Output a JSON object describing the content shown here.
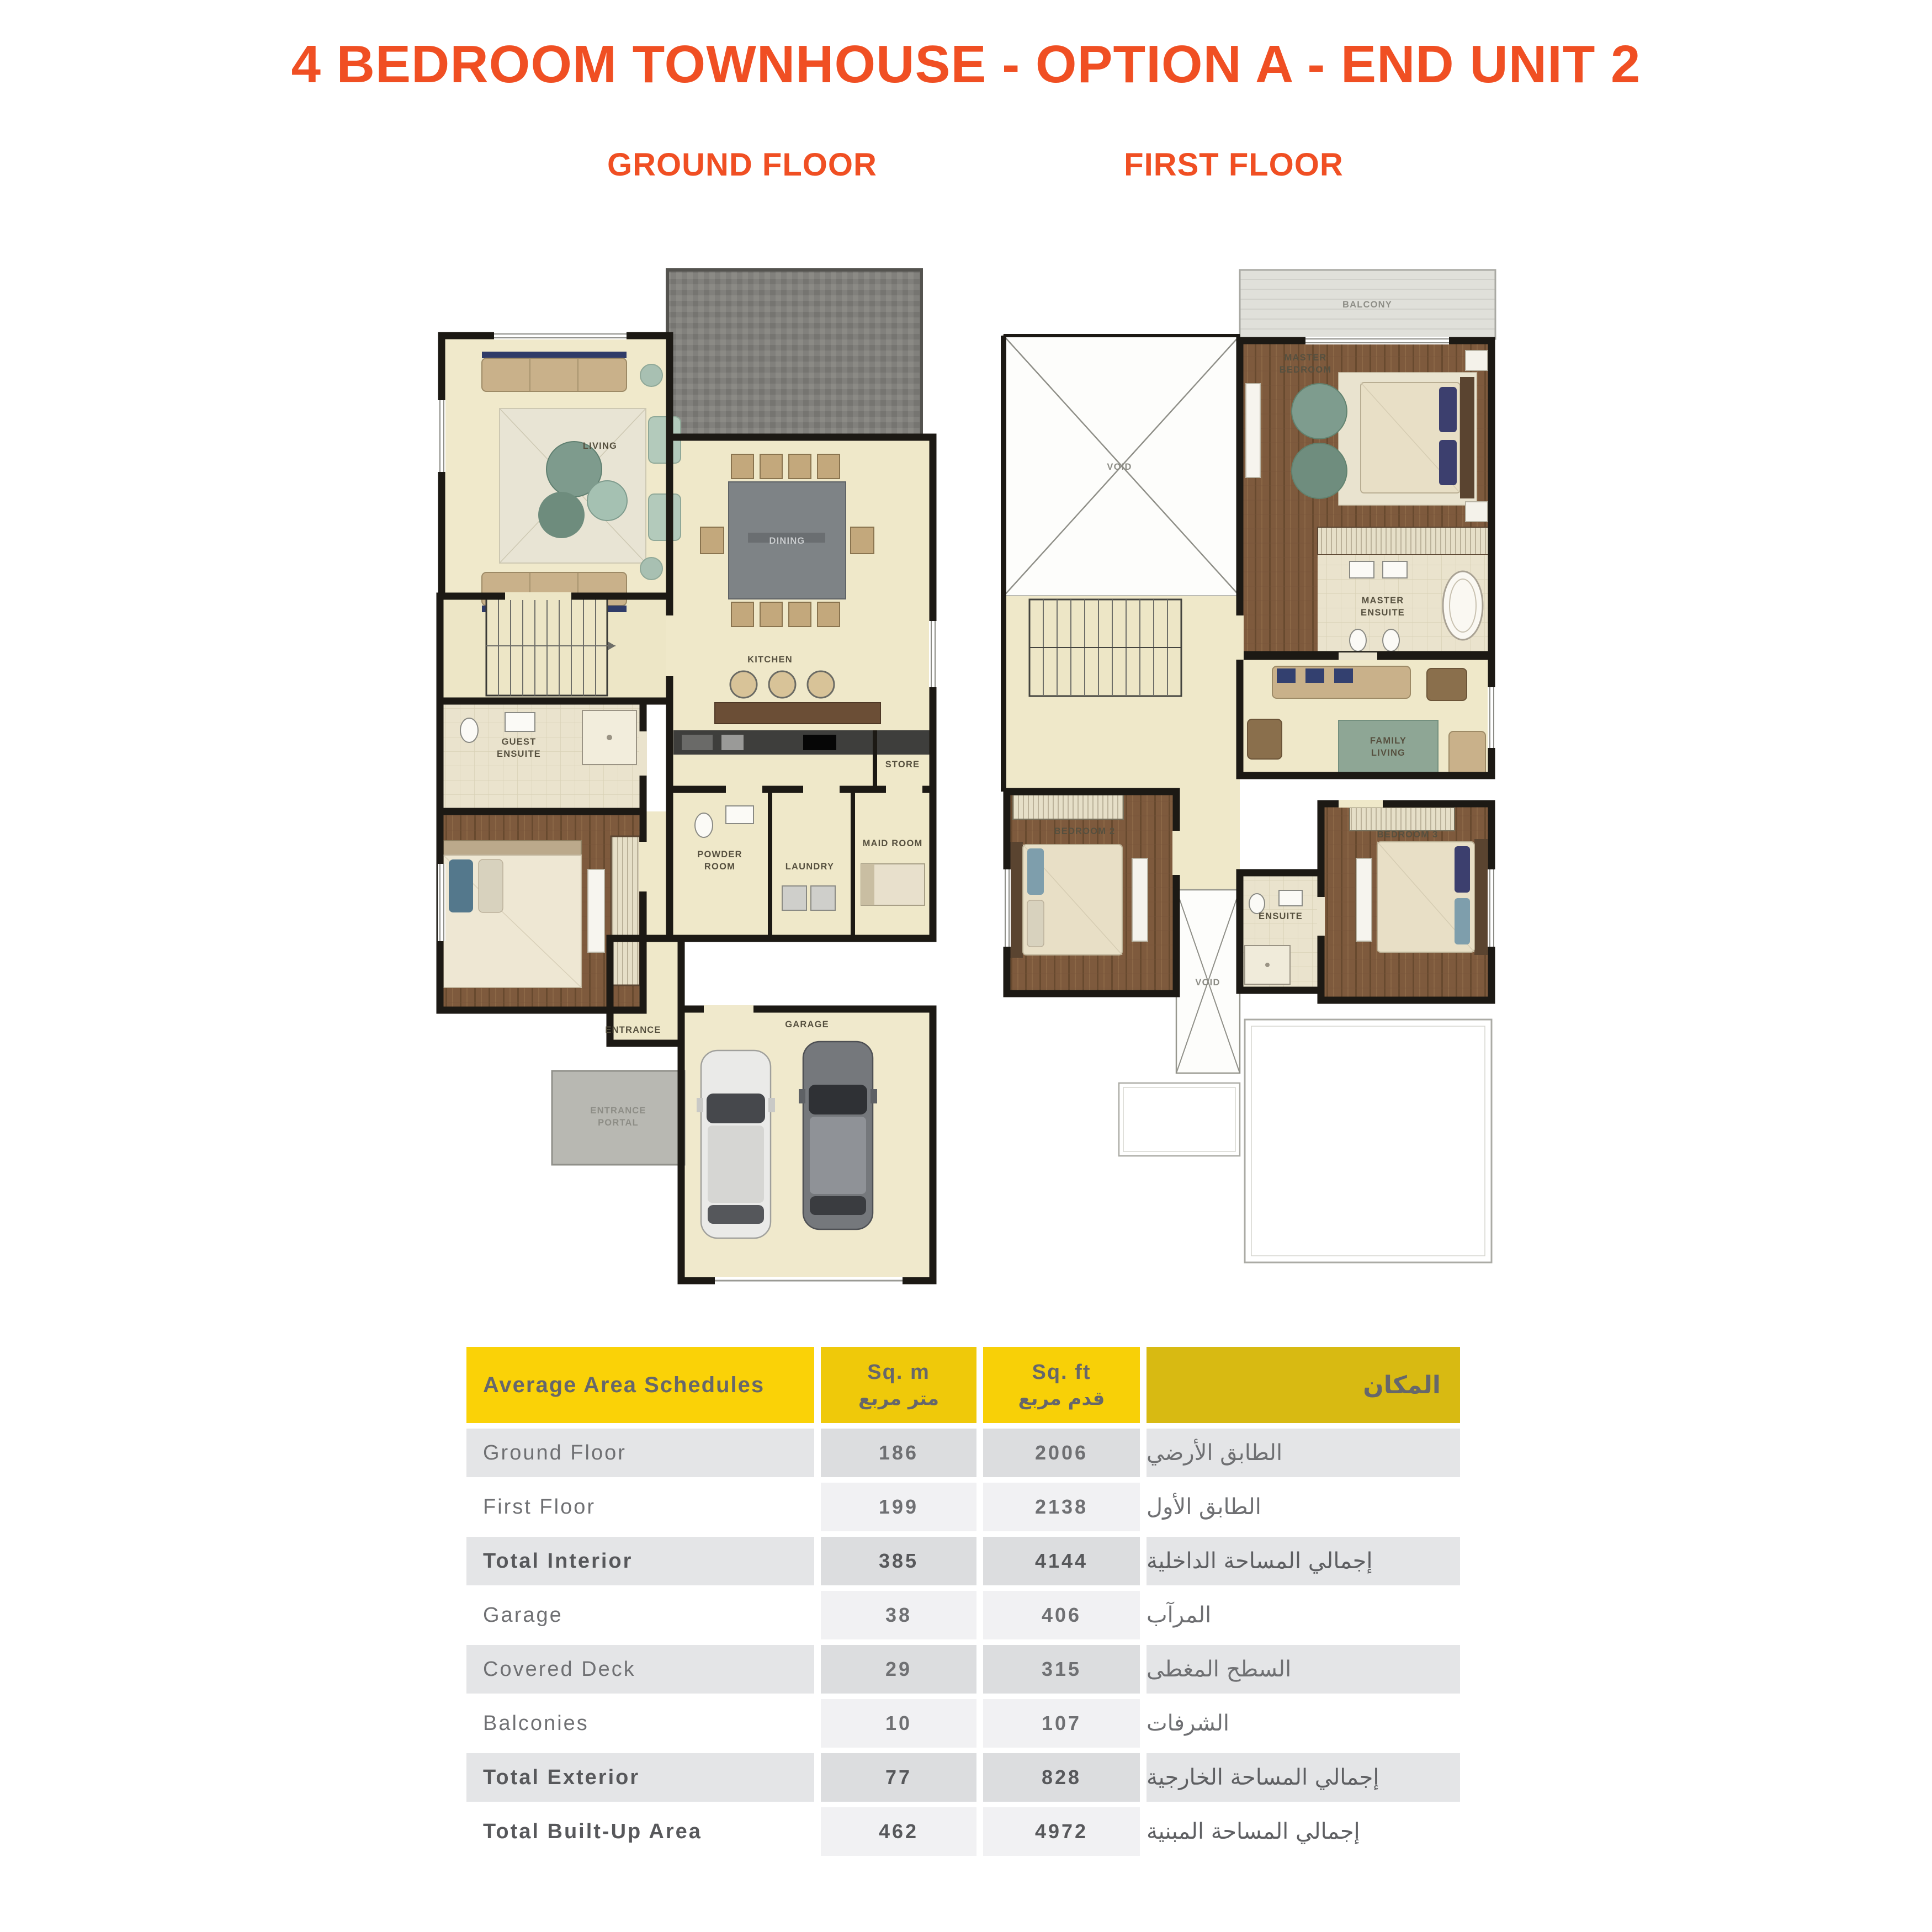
{
  "page": {
    "title": "4 BEDROOM TOWNHOUSE - OPTION A - END UNIT 2"
  },
  "floors": {
    "ground": "GROUND FLOOR",
    "first": "FIRST FLOOR"
  },
  "colors": {
    "accent_orange": "#F04F23",
    "header_yellow_bright": "#FAD207",
    "header_yellow_medium": "#EFC90A",
    "header_yellow_dark": "#D8BA12",
    "row_gray_outer": "#E4E5E7",
    "row_gray_inner": "#DCDDDF",
    "table_text": "#6F7073",
    "floor_cream": "#EFE8C9",
    "floor_wood": "#7E5A3D",
    "deck_gray": "#81807C"
  },
  "plans": {
    "ground": {
      "labels": {
        "living": [
          "LIVING"
        ],
        "dining": [
          "DINING"
        ],
        "kitchen": [
          "KITCHEN"
        ],
        "store": [
          "STORE"
        ],
        "powder": [
          "POWDER",
          "ROOM"
        ],
        "laundry": [
          "LAUNDRY"
        ],
        "maid": [
          "MAID ROOM"
        ],
        "guest_ensuite": [
          "GUEST",
          "ENSUITE"
        ],
        "entrance": [
          "ENTRANCE"
        ],
        "portal": [
          "ENTRANCE",
          "PORTAL"
        ],
        "garage": [
          "GARAGE"
        ]
      }
    },
    "first": {
      "labels": {
        "balcony": [
          "BALCONY"
        ],
        "void_large": [
          "VOID"
        ],
        "master_bedroom": [
          "MASTER",
          "BEDROOM"
        ],
        "master_ensuite": [
          "MASTER",
          "ENSUITE"
        ],
        "family_living": [
          "FAMILY",
          "LIVING"
        ],
        "bedroom2": [
          "BEDROOM 2"
        ],
        "bedroom3": [
          "BEDROOM 3"
        ],
        "ensuite": [
          "ENSUITE"
        ],
        "void_small": [
          "VOID"
        ]
      }
    }
  },
  "table": {
    "header": {
      "col1": "Average Area Schedules",
      "col2_en": "Sq. m",
      "col2_ar": "متر مربع",
      "col3_en": "Sq. ft",
      "col3_ar": "قدم مربع",
      "col4_ar": "المكان"
    },
    "rows": [
      {
        "label": "Ground Floor",
        "sqm": "186",
        "sqft": "2006",
        "ar": "الطابق الأرضي",
        "bold": false,
        "shaded": true
      },
      {
        "label": "First Floor",
        "sqm": "199",
        "sqft": "2138",
        "ar": "الطابق الأول",
        "bold": false,
        "shaded": false
      },
      {
        "label": "Total Interior",
        "sqm": "385",
        "sqft": "4144",
        "ar": "إجمالي المساحة الداخلية",
        "bold": true,
        "shaded": true
      },
      {
        "label": "Garage",
        "sqm": "38",
        "sqft": "406",
        "ar": "المرآب",
        "bold": false,
        "shaded": false
      },
      {
        "label": "Covered Deck",
        "sqm": "29",
        "sqft": "315",
        "ar": "السطح المغطى",
        "bold": false,
        "shaded": true
      },
      {
        "label": "Balconies",
        "sqm": "10",
        "sqft": "107",
        "ar": "الشرفات",
        "bold": false,
        "shaded": false
      },
      {
        "label": "Total Exterior",
        "sqm": "77",
        "sqft": "828",
        "ar": "إجمالي المساحة الخارجية",
        "bold": true,
        "shaded": true
      },
      {
        "label": "Total Built-Up Area",
        "sqm": "462",
        "sqft": "4972",
        "ar": "إجمالي المساحة المبنية",
        "bold": true,
        "shaded": false
      }
    ]
  }
}
